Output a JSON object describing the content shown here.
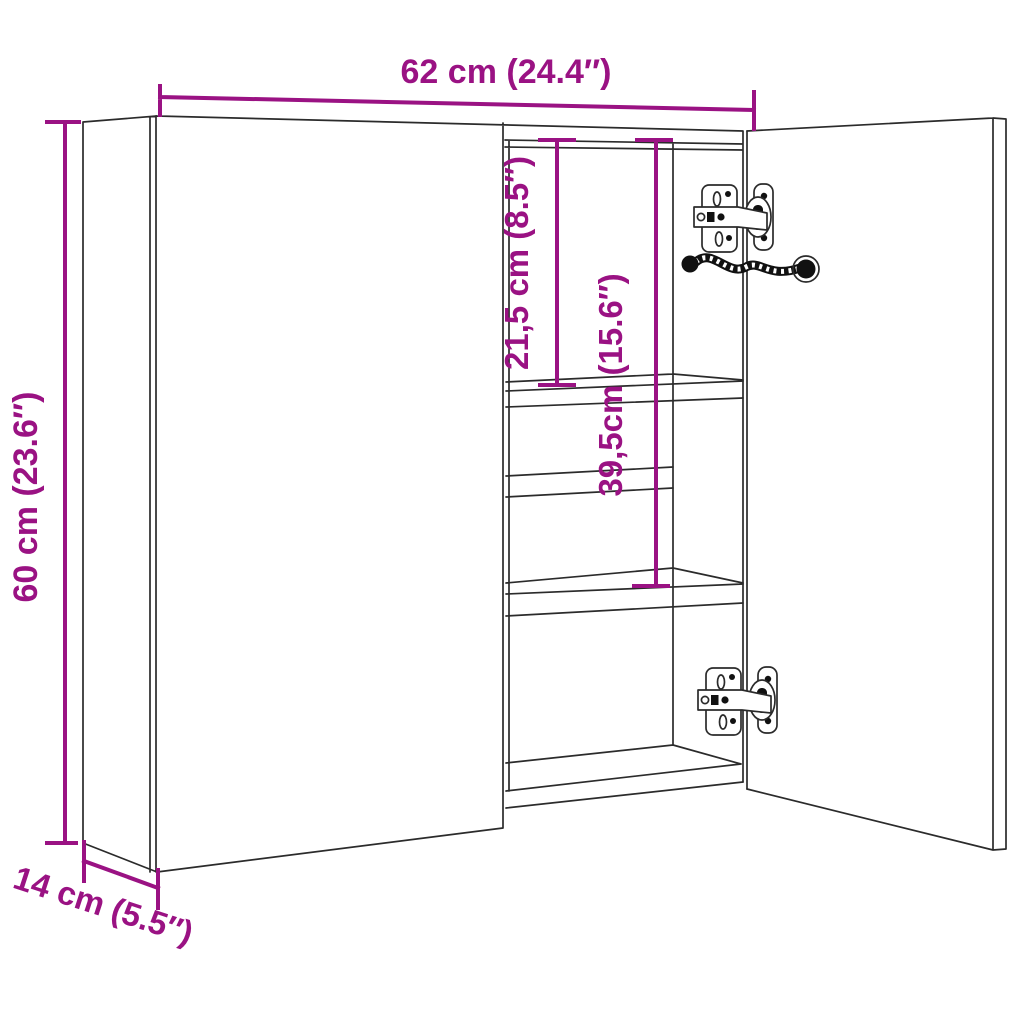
{
  "diagram": {
    "type": "product-dimension-diagram",
    "subject": "wall bathroom mirror cabinet with one open door, inner shelves and two concealed hinges",
    "background_color": "#ffffff",
    "line_color": "#2b2b2b",
    "accent_color": "#9A1283",
    "dimensions": {
      "width": {
        "label": "62 cm (24.4″)",
        "cm": "62",
        "inch": "24.4"
      },
      "height": {
        "label": "60 cm (23.6″)",
        "cm": "60",
        "inch": "23.6"
      },
      "depth": {
        "label": "14 cm (5.5″)",
        "cm": "14",
        "inch": "5.5"
      },
      "top_compartment": {
        "label": "21,5 cm (8.5″)",
        "cm": "21,5",
        "inch": "8.5"
      },
      "upper_compartments": {
        "label": "39,5cm (15.6″)",
        "cm": "39,5",
        "inch": "15.6"
      }
    }
  }
}
